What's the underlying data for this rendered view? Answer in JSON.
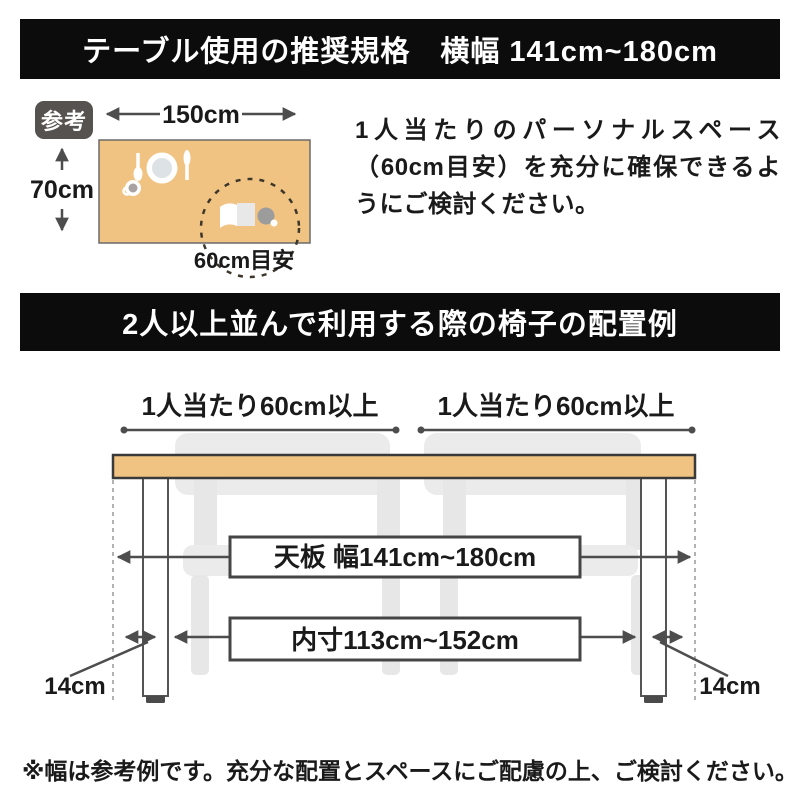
{
  "banners": {
    "top": "テーブル使用の推奨規格　横幅 141cm~180cm",
    "middle": "2人以上並んで利用する際の椅子の配置例"
  },
  "reference": {
    "badge": "参考",
    "table_width": "150cm",
    "table_depth": "70cm",
    "personal_space": "60cm目安",
    "description": "1人当たりのパーソナルスペース（60cm目安）を充分に確保できるようにご検討ください。"
  },
  "layout": {
    "per_person_left": "1人当たり60cm以上",
    "per_person_right": "1人当たり60cm以上",
    "tabletop_width": "天板 幅141cm~180cm",
    "inner_width": "内寸113cm~152cm",
    "leg_offset_left": "14cm",
    "leg_offset_right": "14cm"
  },
  "footer": {
    "note": "※幅は参考例です。充分な配置とスペースにご配慮の上、ご検討ください。"
  },
  "colors": {
    "banner_bg": "#0c0c0c",
    "banner_text": "#ffffff",
    "tabletop_tan": "#f0c382",
    "chair_gray": "#ebebeb",
    "arrow_gray": "#4d4d4d",
    "badge_bg": "#56524f",
    "dashed_circle": "#3d362b"
  }
}
